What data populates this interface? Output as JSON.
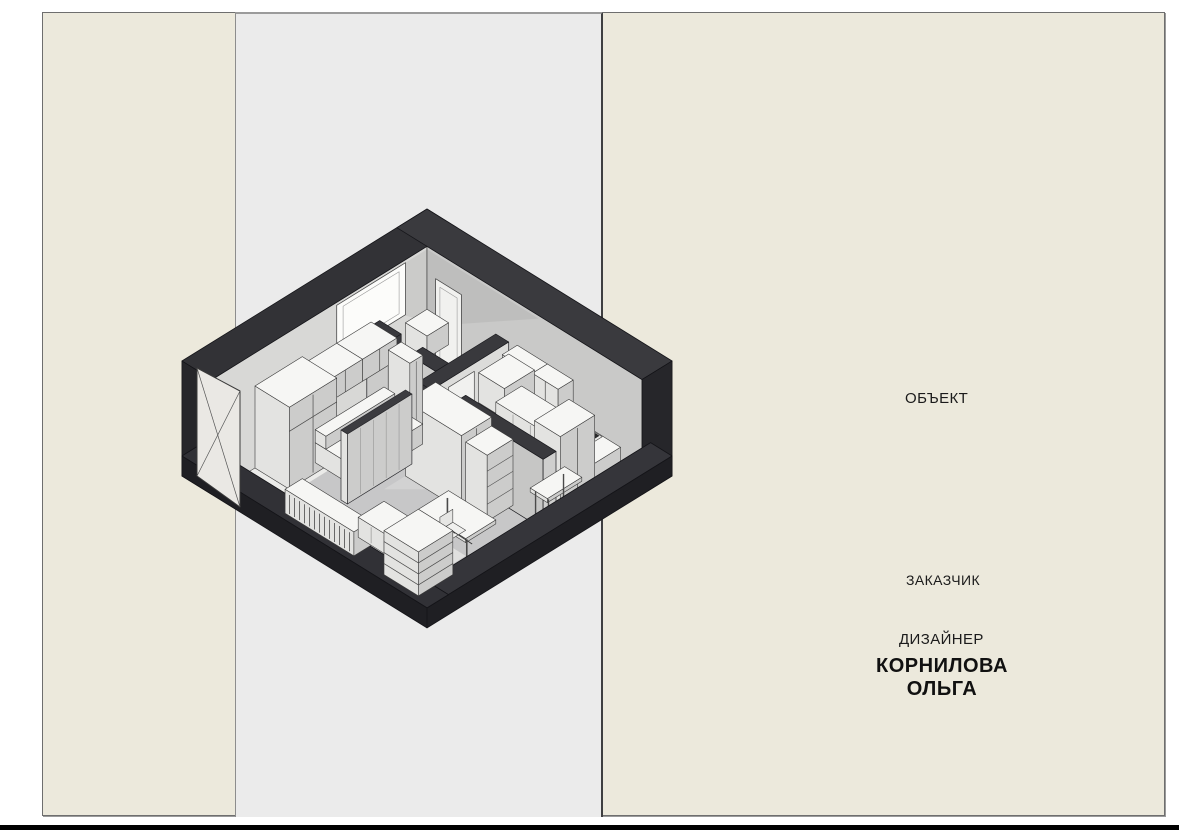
{
  "title_labels": {
    "object": "ОБЪЕКТ",
    "client": "ЗАКАЗЧИК",
    "designer": "ДИЗАЙНЕР",
    "designer_name_first": "КОРНИЛОВА",
    "designer_name_second": "ОЛЬГА"
  },
  "colors": {
    "canvas": "#ffffff",
    "sheet": "#ece9dc",
    "strip": "#ebebeb",
    "bottomBar": "#000000",
    "text": "#1b1b1b",
    "wallTop": "#323236",
    "wallTop2": "#3a3a3e",
    "wallCut": "#26262a",
    "stubOuter": "#1f1f23",
    "partTop": "#39393d",
    "floor": "#c7c7c8",
    "floorDark": "#bebebf",
    "floorLight": "#ebebe9",
    "wallInnerA": "#d8d8d6",
    "wallInnerB": "#c9c9c8",
    "furnTop": "#f6f6f4",
    "furnLeft": "#e3e3e1",
    "furnRight": "#cccccb",
    "outline": "#3b3b3b"
  }
}
